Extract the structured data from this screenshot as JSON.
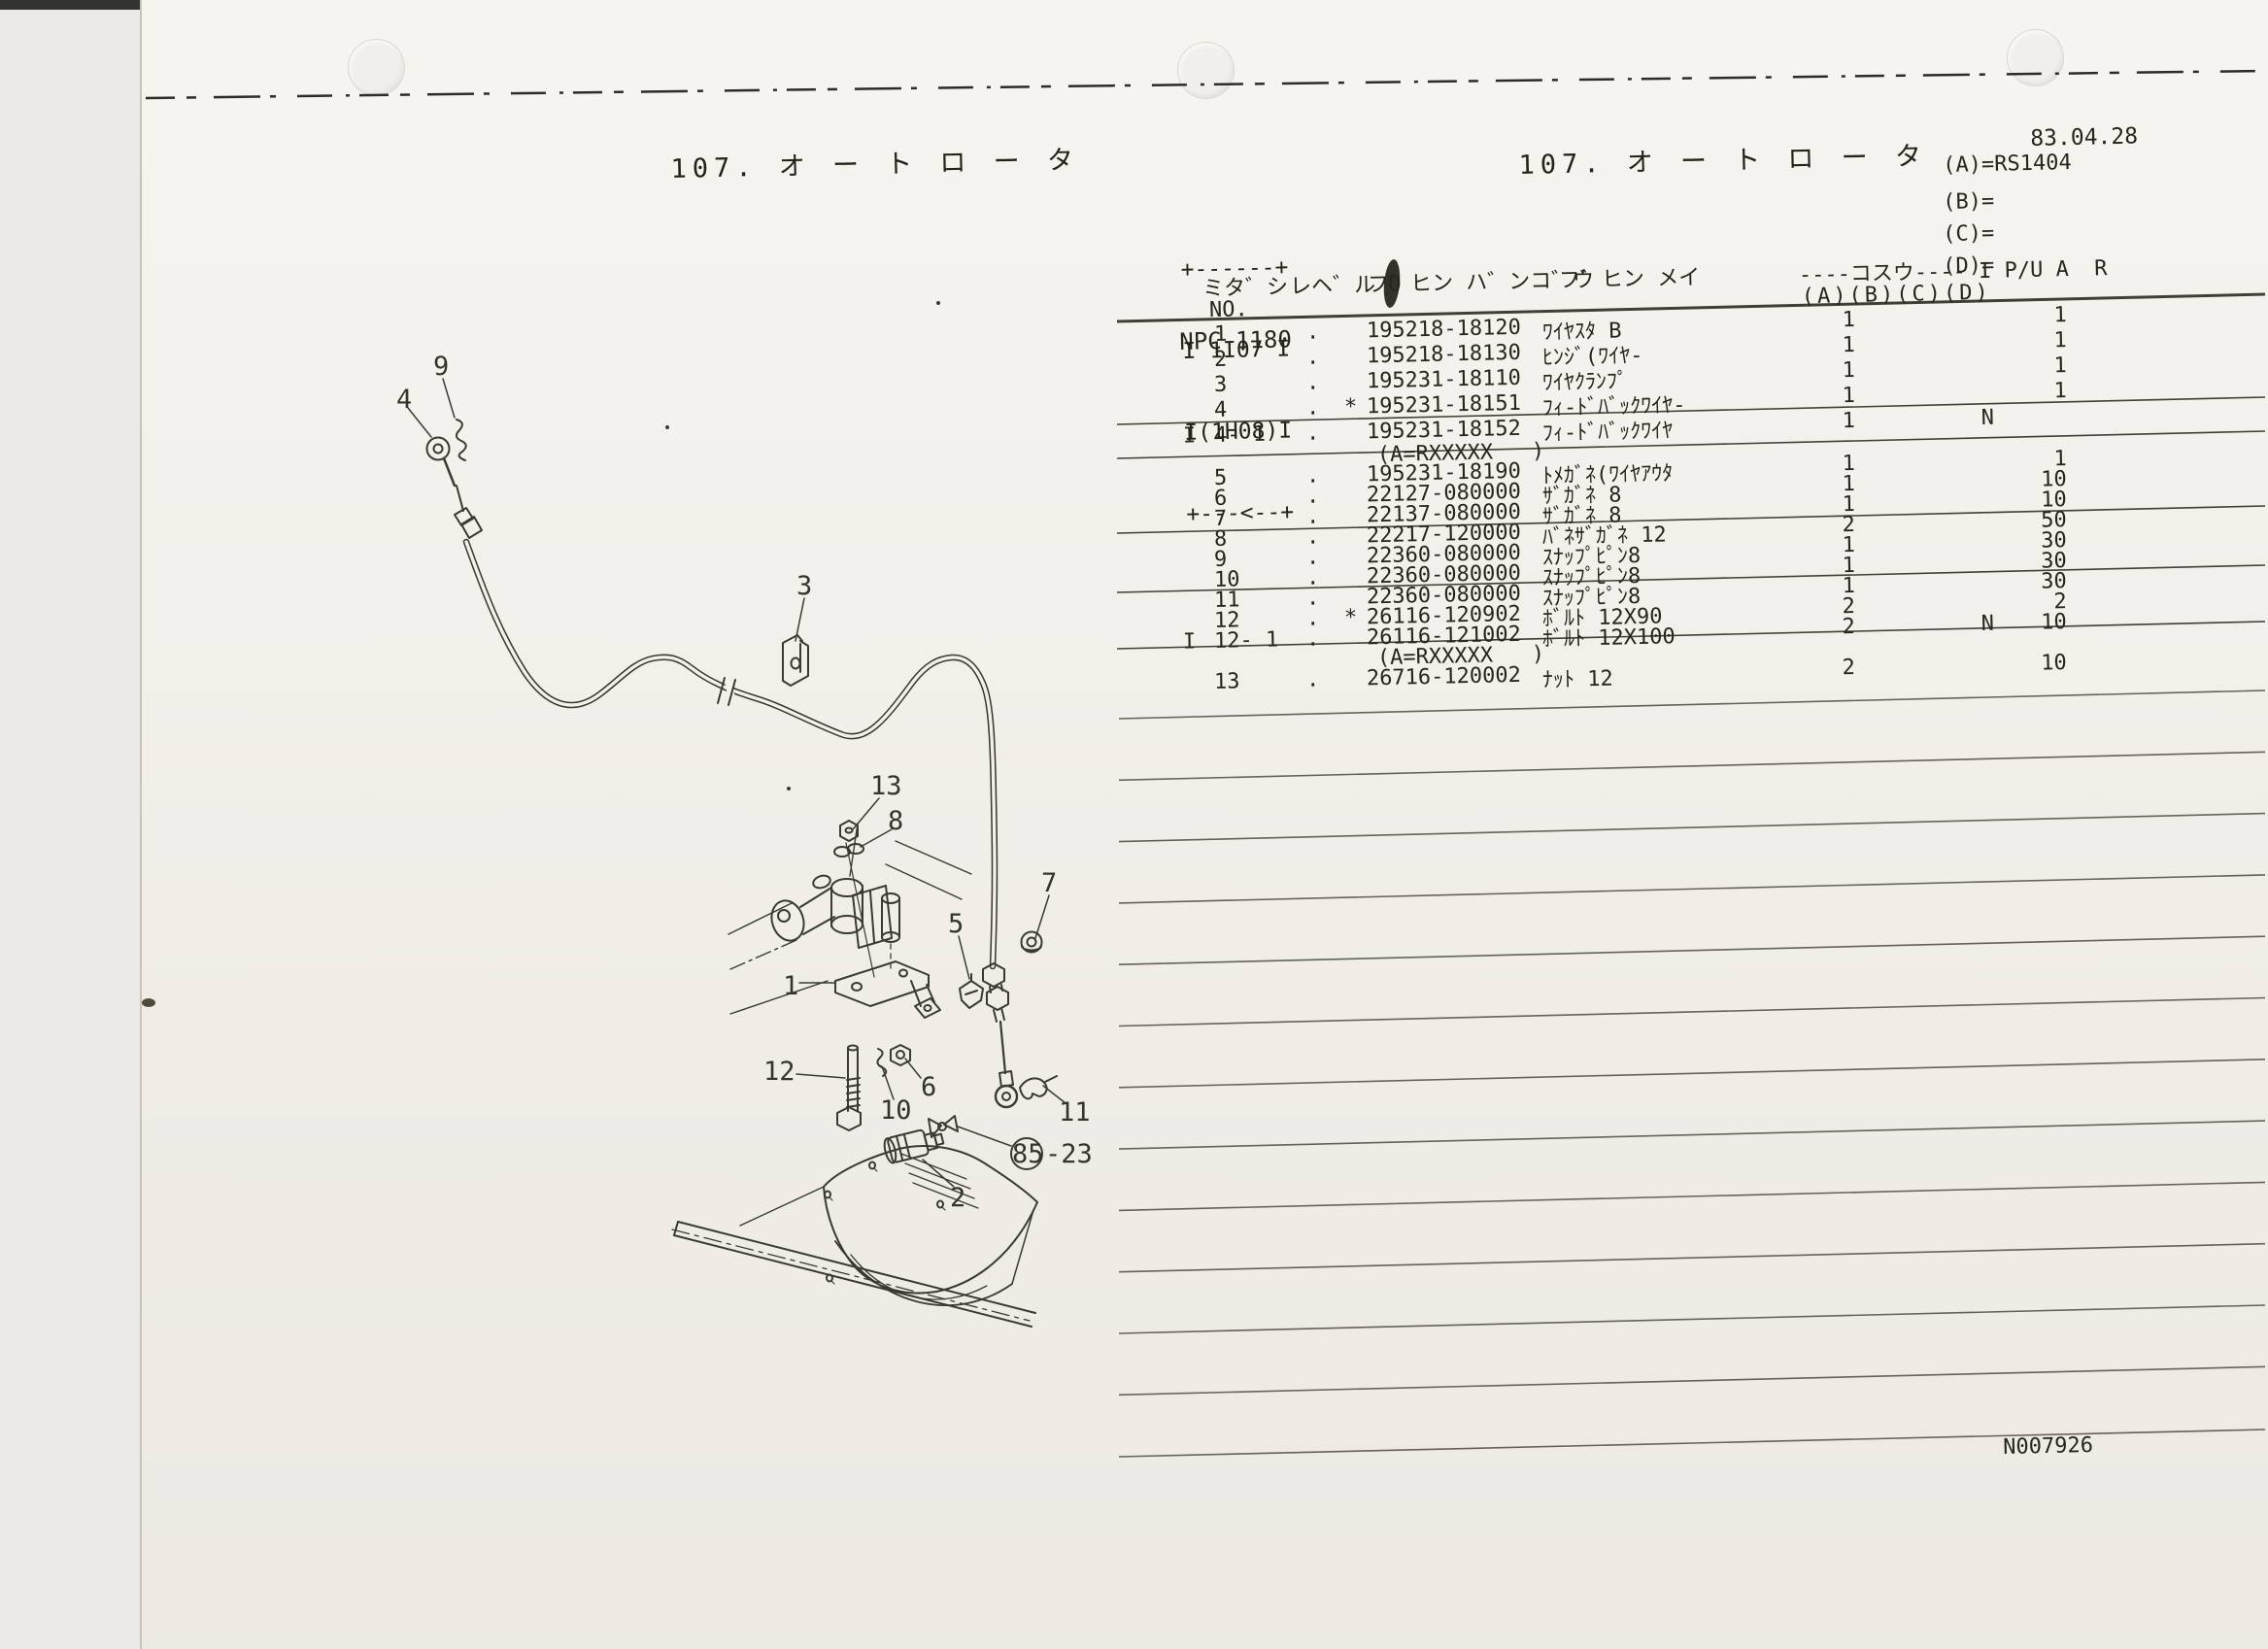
{
  "page": {
    "date": "83.04.28",
    "left_title": "107. オ ー ト ロ ー タ",
    "right_title": "107. オ ー ト ロ ー タ",
    "model_box_lines": [
      "+------+",
      "I 1I07 I",
      "I(1H08)I",
      "+---<--+"
    ],
    "catalog_code": "NPC-1180",
    "applicability": [
      {
        "label": "(A)=",
        "value": "RS1404"
      },
      {
        "label": "(B)=",
        "value": ""
      },
      {
        "label": "(C)=",
        "value": ""
      },
      {
        "label": "(D)=",
        "value": ""
      }
    ],
    "doc_number": "N007926"
  },
  "table": {
    "headers": {
      "midashi": "ミタ゛シ",
      "midashi_sub": "NO.",
      "level": "レヘ゛ル O",
      "part_number": "フ゛ヒン ハ゛ンコ゛ウ",
      "part_name": "フ゛ヒン メイ",
      "kosuu": "----コスウ---- I P/U A  R",
      "kosuu_sub": "(A)(B)(C)(D)"
    },
    "rows": [
      {
        "no": "1",
        "lv": ".",
        "pn": "195218-18120",
        "nm": "ﾜｲﾔｽﾀ B",
        "a": "1",
        "r": "1"
      },
      {
        "no": "2",
        "lv": ".",
        "pn": "195218-18130",
        "nm": "ﾋﾝｼﾞ(ﾜｲﾔ-",
        "a": "1",
        "r": "1"
      },
      {
        "no": "3",
        "lv": ".",
        "pn": "195231-18110",
        "nm": "ﾜｲﾔｸﾗﾝﾌﾟ",
        "a": "1",
        "r": "1"
      },
      {
        "no": "4",
        "lv": ".",
        "star": "*",
        "pn": "195231-18151",
        "nm": "ﾌｨ-ﾄﾞﾊﾞｯｸﾜｲﾔ-",
        "a": "1",
        "r": "1"
      },
      {
        "pre": "I",
        "no": "4- 1",
        "lv": ".",
        "pn": "195231-18152",
        "nm": "ﾌｨ-ﾄﾞﾊﾞｯｸﾜｲﾔ",
        "a": "1",
        "pu": "N"
      },
      {
        "note": "(A=RXXXXX   )"
      },
      {
        "no": "5",
        "lv": ".",
        "pn": "195231-18190",
        "nm": "ﾄﾒｶﾞﾈ(ﾜｲﾔｱｳﾀ",
        "a": "1",
        "r": "1"
      },
      {
        "no": "6",
        "lv": ".",
        "pn": "22127-080000",
        "nm": "ｻﾞｶﾞﾈ 8",
        "a": "1",
        "r": "10"
      },
      {
        "no": "7",
        "lv": ".",
        "pn": "22137-080000",
        "nm": "ｻﾞｶﾞﾈ 8",
        "a": "1",
        "r": "10"
      },
      {
        "no": "8",
        "lv": ".",
        "pn": "22217-120000",
        "nm": "ﾊﾞﾈｻﾞｶﾞﾈ 12",
        "a": "2",
        "r": "50"
      },
      {
        "no": "9",
        "lv": ".",
        "pn": "22360-080000",
        "nm": "ｽﾅｯﾌﾟﾋﾟﾝ8",
        "a": "1",
        "r": "30"
      },
      {
        "no": "10",
        "lv": ".",
        "pn": "22360-080000",
        "nm": "ｽﾅｯﾌﾟﾋﾟﾝ8",
        "a": "1",
        "r": "30"
      },
      {
        "no": "11",
        "lv": ".",
        "pn": "22360-080000",
        "nm": "ｽﾅｯﾌﾟﾋﾟﾝ8",
        "a": "1",
        "r": "30"
      },
      {
        "no": "12",
        "lv": ".",
        "star": "*",
        "pn": "26116-120902",
        "nm": "ﾎﾞﾙﾄ 12X90",
        "a": "2",
        "r": "2"
      },
      {
        "pre": "I",
        "no": "12- 1",
        "lv": ".",
        "pn": "26116-121002",
        "nm": "ﾎﾞﾙﾄ 12X100",
        "a": "2",
        "pu": "N",
        "r": "10"
      },
      {
        "note": "(A=RXXXXX   )"
      },
      {
        "no": "13",
        "lv": ".",
        "pn": "26716-120002",
        "nm": "ﾅｯﾄ 12",
        "a": "2",
        "r": "10"
      }
    ]
  },
  "diagram": {
    "callouts": [
      "4",
      "9",
      "3",
      "13",
      "8",
      "5",
      "7",
      "1",
      "12",
      "6",
      "10",
      "11",
      "2"
    ],
    "ref_circle_label": "85",
    "ref_suffix": "-23"
  }
}
